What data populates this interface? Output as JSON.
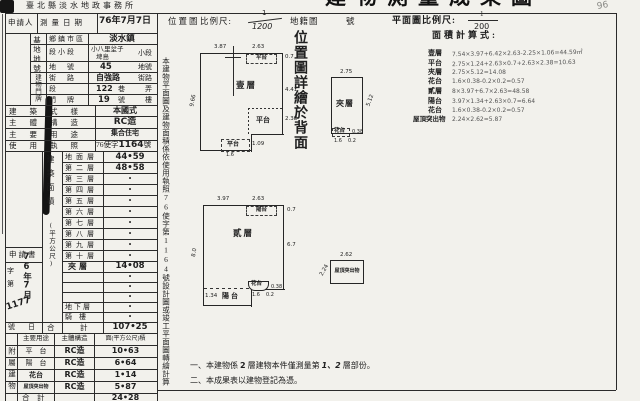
{
  "scan": {
    "top_title_fragment": "建物測量成果圖",
    "top_left_fragment_1": "臺北縣淡水地政事務所",
    "top_left_fragment_2": "收件年月日字號",
    "pencil_note": "96"
  },
  "header": {
    "applicant_label": "申請人",
    "survey_date_label": "測量日期",
    "survey_date_value": "76年7月7日",
    "location_map_label": "位置圖",
    "scale_label": "比例尺:",
    "scale_numerator": "1",
    "scale_denominator": "1200",
    "cadastral_map_label": "地籍圖",
    "cadastral_no_suffix": "號",
    "plan_scale_label": "平面圖比例尺:",
    "plan_scale_numerator": "1",
    "plan_scale_denominator": "200"
  },
  "site": {
    "col_label_top": "基地地號",
    "col_label_bottom": "建物門牌",
    "rows": [
      {
        "label": "鄉鎮市區",
        "value": "淡水鎮",
        "suffix": ""
      },
      {
        "label": "段小段",
        "value": "小八里坌子",
        "value2": "埤島",
        "suffix": "小段"
      },
      {
        "label": "地　號",
        "value": "45",
        "suffix": "地號"
      },
      {
        "label": "街　路",
        "value": "自強路",
        "suffix": "街路"
      },
      {
        "label": "段",
        "value": "122",
        "mid": "巷",
        "suffix": "弄"
      },
      {
        "label": "門　牌",
        "value": "19",
        "mid": "號",
        "suffix": "樓"
      }
    ]
  },
  "info": {
    "rows": [
      {
        "label": "建築式樣",
        "value": "本國式"
      },
      {
        "label": "主體構造",
        "value": "RC造"
      },
      {
        "label": "主要用途",
        "value": "集合住宅"
      },
      {
        "label": "使用執照",
        "value_prefix": "76使字",
        "value_num": "1164",
        "value_suffix": "號"
      }
    ]
  },
  "floor_area": {
    "col_label": "建築面積",
    "col_unit": "(平方公尺)",
    "rows": [
      {
        "label": "地面層",
        "value": "44•59"
      },
      {
        "label": "第二層",
        "value": "48•58"
      },
      {
        "label": "第三層",
        "value": "•"
      },
      {
        "label": "第四層",
        "value": "•"
      },
      {
        "label": "第五層",
        "value": "•"
      },
      {
        "label": "第六層",
        "value": "•"
      },
      {
        "label": "第七層",
        "value": "•"
      },
      {
        "label": "第八層",
        "value": "•"
      },
      {
        "label": "第九層",
        "value": "•"
      },
      {
        "label": "第十層",
        "value": "•"
      },
      {
        "label": "夾層",
        "value": "14•08"
      },
      {
        "label": "",
        "value": "•"
      },
      {
        "label": "",
        "value": "•"
      },
      {
        "label": "",
        "value": "•"
      },
      {
        "label": "地下層",
        "value": "•"
      },
      {
        "label": "騎　樓",
        "value": "•"
      }
    ],
    "total_label_1": "合",
    "total_label_2": "計",
    "total_value": "107•25"
  },
  "application": {
    "title": "申請書",
    "zi": "字",
    "di": "第",
    "date_hw": "76年7月",
    "number_hw": "1177",
    "no_label": "號",
    "day_label": "日"
  },
  "attached": {
    "col_label": "附屬建物",
    "headers": [
      "主要用途",
      "主體構造",
      "面(平方公尺)積"
    ],
    "rows": [
      {
        "use": "平　台",
        "structure": "RC造",
        "area": "10•63"
      },
      {
        "use": "陽　台",
        "structure": "RC造",
        "area": "6•64"
      },
      {
        "use": "花台",
        "structure": "RC造",
        "area": "1•14"
      },
      {
        "use": "屋頂突出物",
        "structure": "RC造",
        "area": "5•87"
      }
    ],
    "total_label": "合　計",
    "total_value": "24•28"
  },
  "side_note": "本建物平面圖及建物面積係依使用執照76使字第1164號設計圖或竣工平面圖轉繪計算",
  "location_note": "位置圖詳繪於背面",
  "calc": {
    "title": "面積計算式:",
    "lines": [
      {
        "label": "壹層",
        "expr": "7.54×3.97+6.42×2.63-2.25×1.06=44.59㎡"
      },
      {
        "label": "平台",
        "expr": "2.75×1.24+2.63×0.7+2.63×2.38=10.63"
      },
      {
        "label": "夾層",
        "expr": "2.75×5.12=14.08"
      },
      {
        "label": "花台",
        "expr": "1.6×0.38-0.2×0.2=0.57"
      },
      {
        "label": "貳層",
        "expr": "8×3.97+6.7×2.63=48.58"
      },
      {
        "label": "陽台",
        "expr": "3.97×1.34+2.63×0.7=6.64"
      },
      {
        "label": "花台",
        "expr": "1.6×0.38-0.2×0.2=0.57"
      },
      {
        "label": "屋頂突出物",
        "expr": "2.24×2.62=5.87"
      }
    ]
  },
  "plans": {
    "floor1": {
      "name": "壹層",
      "terrace": "平台",
      "dim_top_left": "3.87",
      "dim_top_right": "2.63",
      "dim_right_top": "0.7",
      "dim_right_mid": "4.41",
      "dim_right_low": "2.38",
      "dim_left": "9.66",
      "dim_bottom": "1.09",
      "dim_bottom_small": "1.6"
    },
    "mezzanine": {
      "name": "夾層",
      "flower": "花台",
      "dim_top": "2.75",
      "dim_right": "5.12",
      "dim_flower_right": "0.38",
      "dim_flower_1": "1.6",
      "dim_flower_2": "0.2"
    },
    "floor2": {
      "name": "貳層",
      "balcony": "陽台",
      "flower": "花台",
      "dim_top_left": "3.97",
      "dim_top_right": "2.63",
      "dim_right_top": "0.7",
      "dim_right": "6.7",
      "dim_left": "8.0",
      "dim_balcony": "1.34",
      "dim_flower_1": "1.6",
      "dim_flower_2": "0.2",
      "dim_flower_right": "0.38"
    },
    "roof": {
      "name": "屋頂突出物",
      "dim_top": "2.62",
      "dim_left": "2.24"
    }
  },
  "notes": {
    "n1_pre": "一、本建物係",
    "n1_num": "2",
    "n1_mid": "層建物本件僅測量第",
    "n1_floors": "1、2",
    "n1_suf": "層部份。",
    "n2": "二、本成果表以建物登記為憑。"
  }
}
